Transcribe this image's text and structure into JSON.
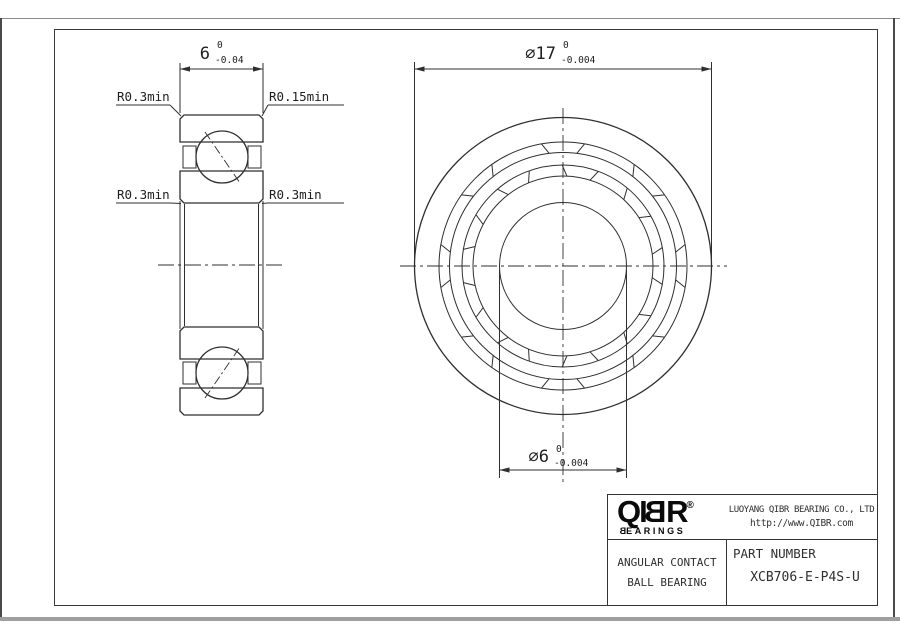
{
  "side_view": {
    "width_dim": {
      "nominal": "6",
      "upper": "0",
      "lower": "-0.04"
    },
    "fillet_top_left": "R0.3min",
    "fillet_top_right": "R0.15min",
    "fillet_mid_left": "R0.3min",
    "fillet_mid_right": "R0.3min"
  },
  "front_view": {
    "outer_dia_dim": {
      "nominal": "∅17",
      "upper": "0",
      "lower": "-0.004"
    },
    "bore_dia_dim": {
      "nominal": "∅6",
      "upper": "0",
      "lower": "-0.004"
    }
  },
  "title_block": {
    "logo": {
      "letters": [
        "Q",
        "I",
        "B",
        "R"
      ],
      "registered": "®",
      "sub_first": "B",
      "sub_rest": "EARINGS"
    },
    "company_name": "LUOYANG QIBR BEARING CO., LTD",
    "website": "http://www.QIBR.com",
    "product_type_line1": "ANGULAR CONTACT",
    "product_type_line2": "BALL BEARING",
    "part_number_label": "PART NUMBER",
    "part_number": "XCB706-E-P4S-U"
  },
  "colors": {
    "line": "#2f2f2f",
    "background": "#ffffff",
    "frame": "#3a3a3a",
    "bottom_bar": "#9f9f9f"
  }
}
